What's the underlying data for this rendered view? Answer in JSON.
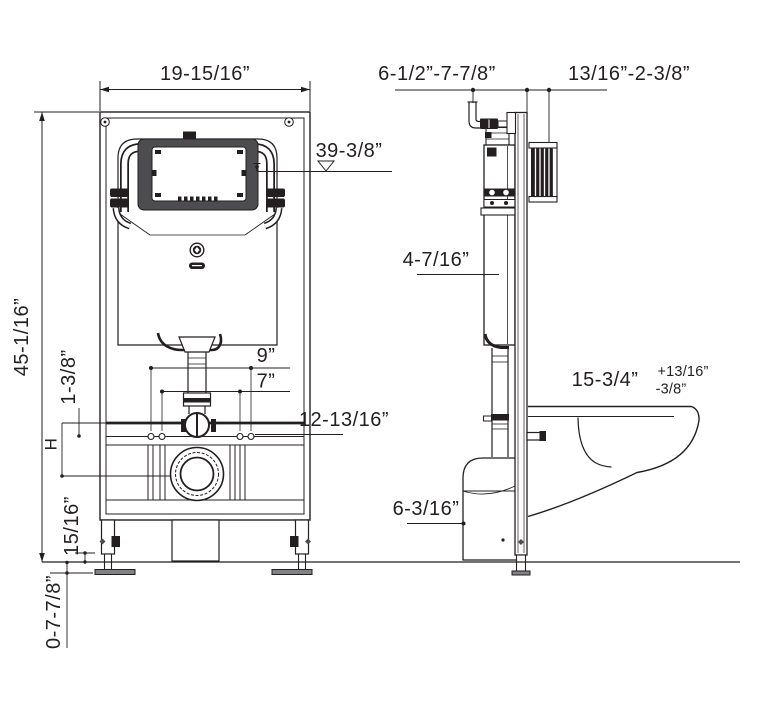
{
  "meta": {
    "description": "Wall-hung toilet in-wall tank and carrier frame installation diagram, front and side elevation views with dimensions"
  },
  "labels": {
    "front": {
      "frame_width": "19-15/16”",
      "overall_height": "45-1/16”",
      "actuator_height": "39-3/8”",
      "outer_bolt_spacing": "9”",
      "inner_bolt_spacing": "7”",
      "rail_height": "12-13/16”",
      "clamp_offset": "1-3/8”",
      "variable_height": "H",
      "foot_gap": "15/16”",
      "foot_adjustment": "0-7-7/8”"
    },
    "side": {
      "supply_rough_in": "6-1/2”-7-7/8”",
      "wall_thickness": "13/16”-2-3/8”",
      "tank_depth": "4-7/16”",
      "bowl_projection": "15-3/4”",
      "bowl_tol_plus": "+13/16”",
      "bowl_tol_minus": "-3/8”",
      "drain_height": "6-3/16”"
    }
  },
  "colors": {
    "line": "#231f20",
    "panel_gray": "#4d4d4f",
    "foot_gray": "#808285",
    "background": "#ffffff"
  }
}
